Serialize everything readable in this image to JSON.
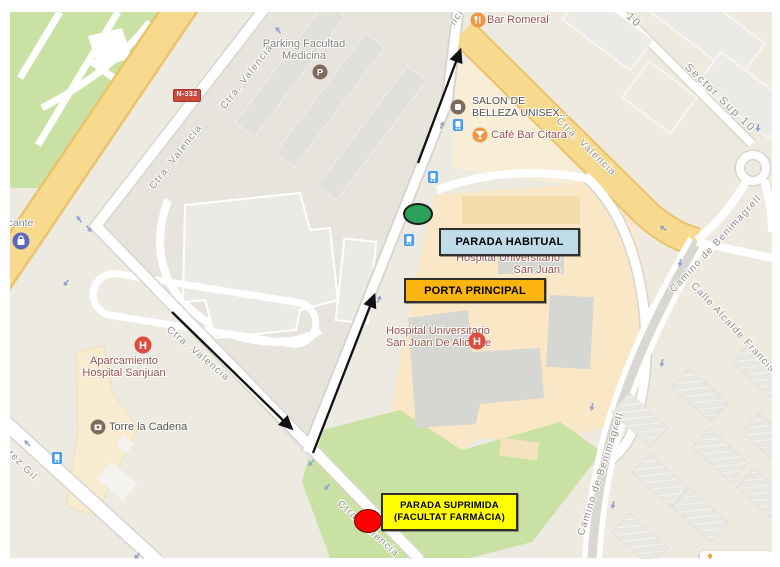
{
  "streets": {
    "ctra_valencia": "Ctra. Valencia",
    "ctra_valencia_partial": "ncia",
    "sector_sup_10": "Sector Sup 10",
    "sector_sup_10_partial": "p 10",
    "camino_benimagrell": "Camino de Benimagrell",
    "calle_alcalde": "Calle Alcalde Francisc",
    "perez_gil": "érez Gil",
    "n332_shield": "N-332"
  },
  "pois": {
    "bar_romeral": "Bar Romeral",
    "parking_line1": "Parking Facultad",
    "parking_line2": "Medicina",
    "salon_line1": "SALON DE",
    "salon_line2": "BELLEZA UNISEX...",
    "cafe_bar_citara": "Café Bar Citara",
    "hospital_upper_line1": "Hospital Universitario",
    "hospital_upper_line2": "San Juan",
    "hospital_lower_line1": "Hospital Universitario",
    "hospital_lower_line2": "San Juan De Alicante",
    "aparcamiento_line1": "Aparcamiento",
    "aparcamiento_line2": "Hospital Sanjuan",
    "torre_la_cadena": "Torre la Cadena",
    "alicante_partial": "licante"
  },
  "annotations": {
    "parada_habitual": "PARADA HABITUAL",
    "porta_principal": "PORTA PRINCIPAL",
    "parada_suprimida_line1": "PARADA SUPRIMIDA",
    "parada_suprimida_line2": "(FACULTAT FARMÀCIA)"
  },
  "colors": {
    "habitual_fill": "#BFDCE8",
    "principal_fill": "#FCB40F",
    "suprimida_fill": "#FFFF00",
    "marker_green": "#2BA159",
    "marker_red": "#FF0000",
    "route_arrow": "#111111"
  }
}
